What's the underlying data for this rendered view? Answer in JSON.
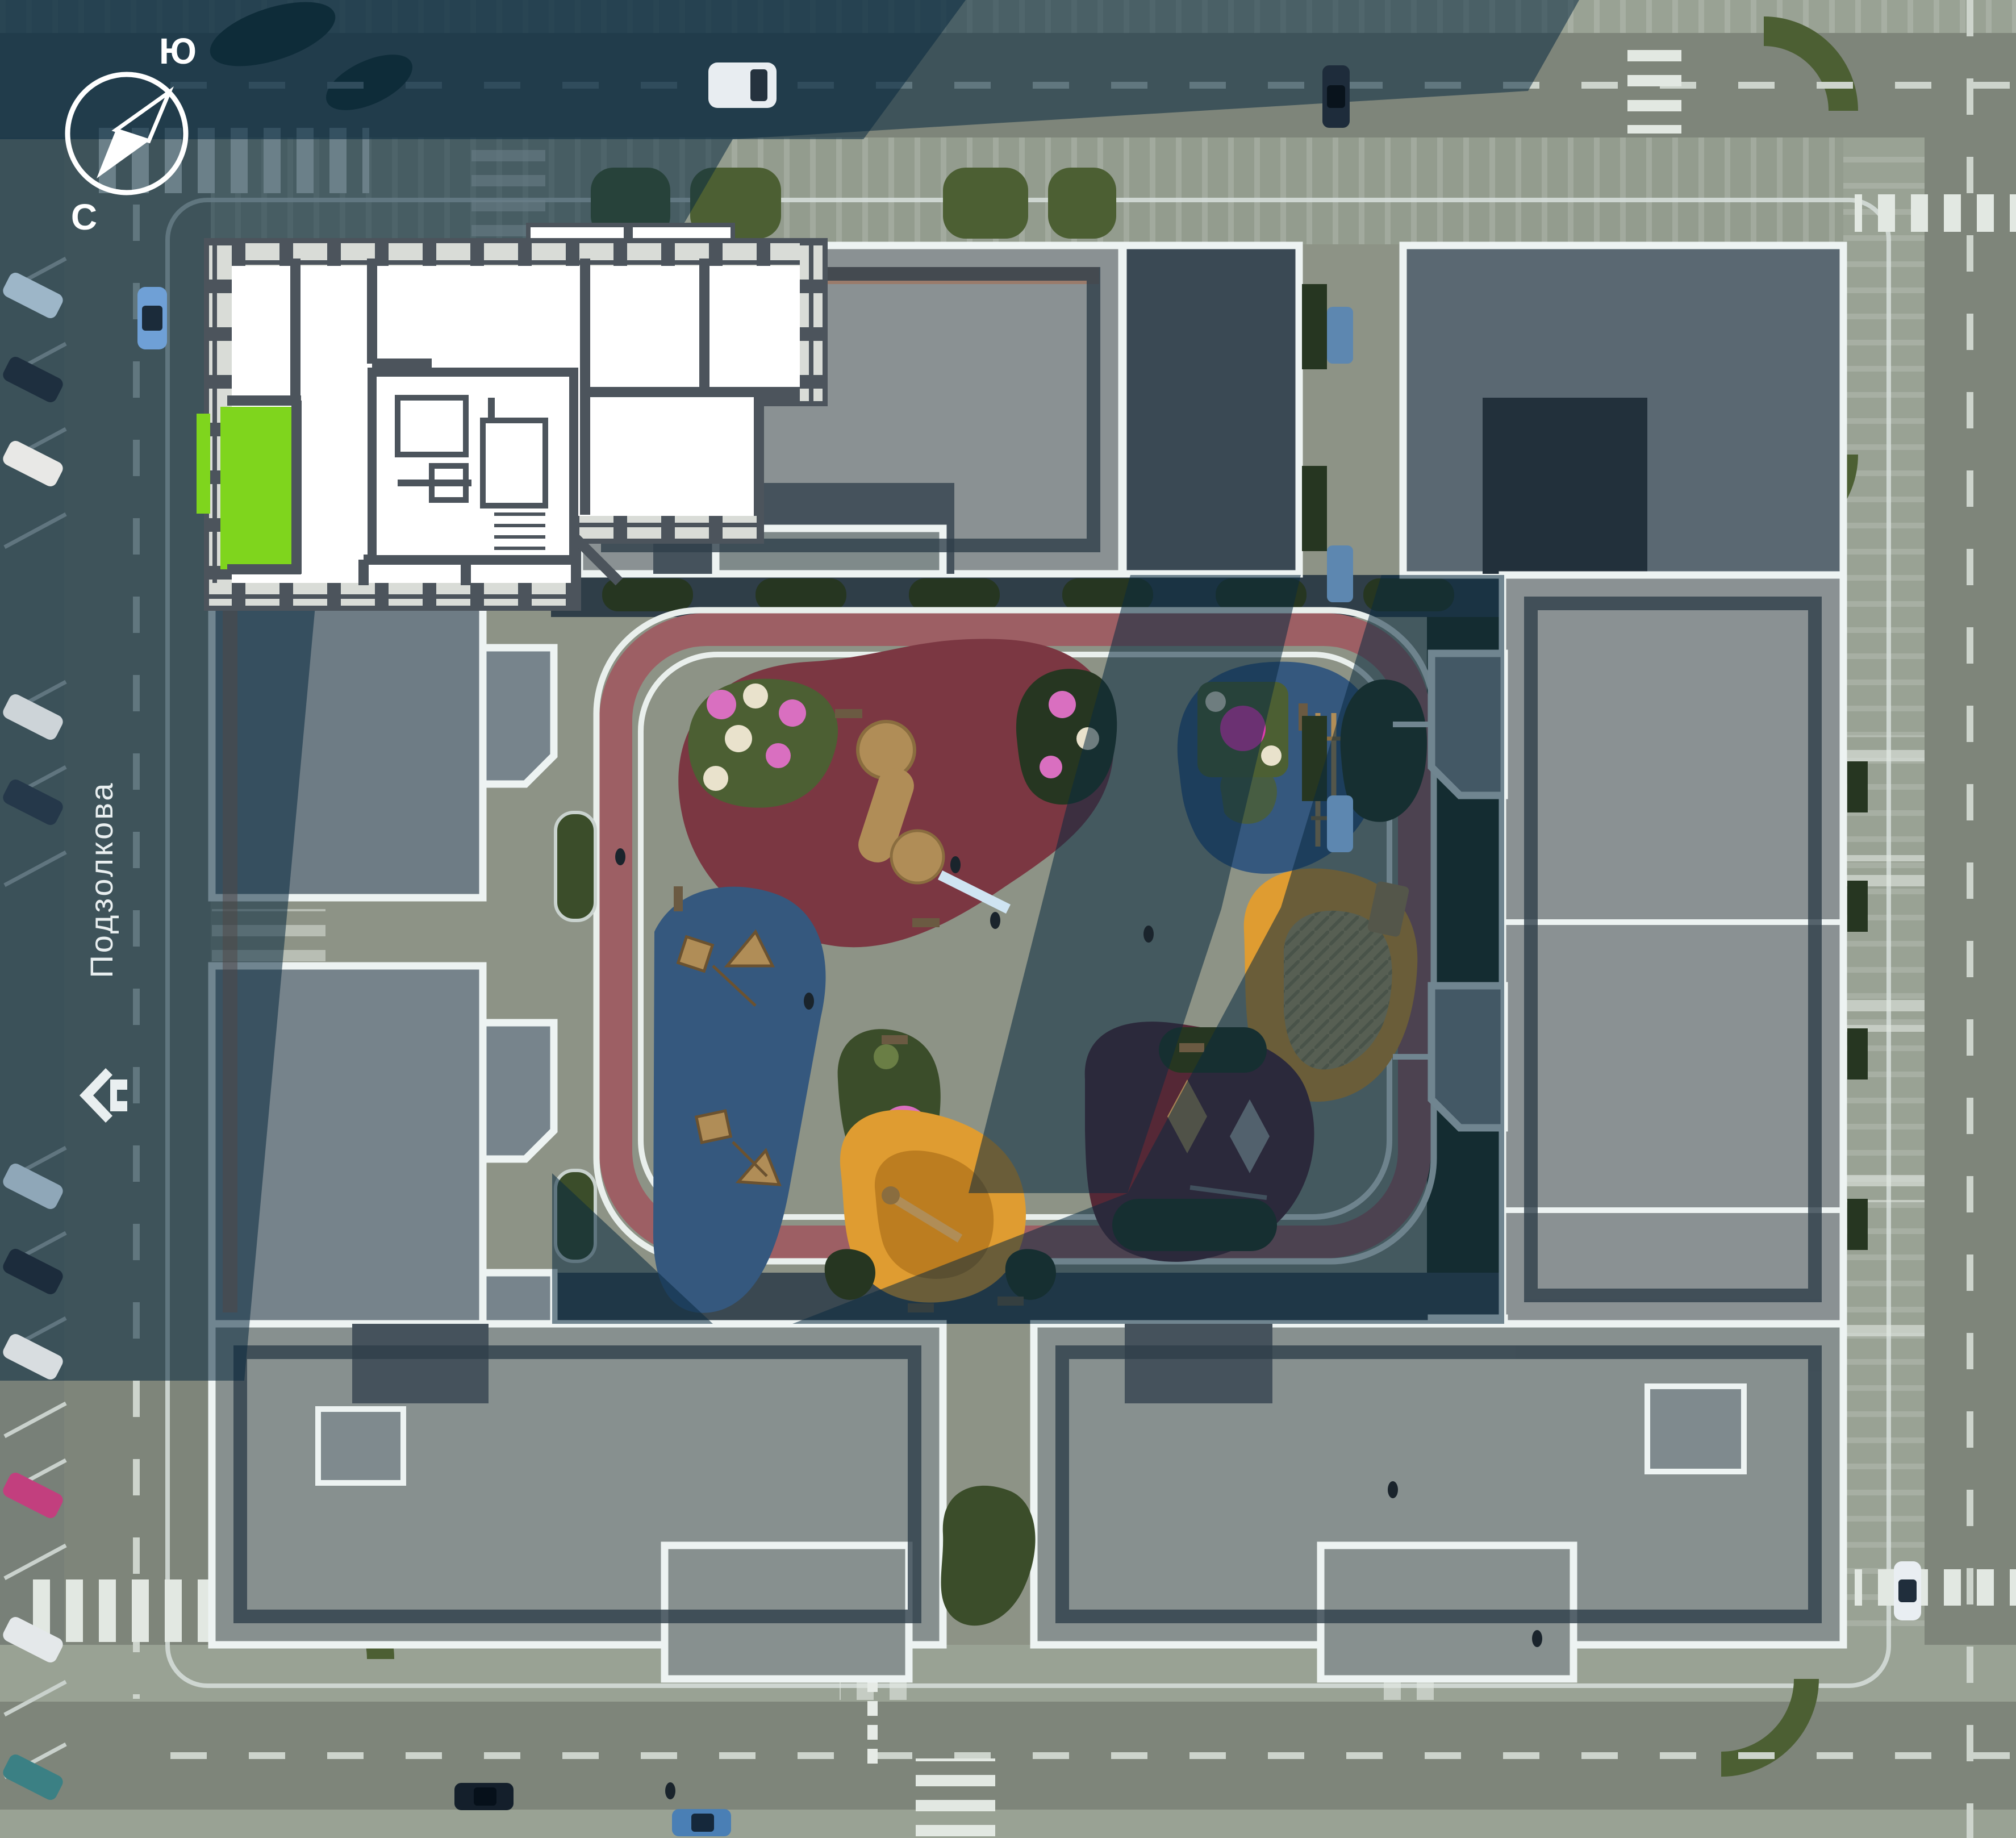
{
  "scene": {
    "type": "residential-complex-aerial-site-plan",
    "compass": {
      "label_top": "Ю",
      "label_bottom": "С"
    },
    "street": {
      "name": "Подзолкова"
    },
    "selected_apartment": {
      "highlight_color": "#7FD51D"
    },
    "colors": {
      "ground": "#8D9386",
      "road": "#7E857A",
      "sidewalk": "#99A294",
      "roof_light": "#8A9193",
      "roof_medium": "#5A6872",
      "roof_dark": "#3D4B56",
      "roof_low": "#45525C",
      "parapet": "#EDF3F2",
      "accent_roofline": "#A86A4B",
      "shadow": "#0A2940",
      "track_red": "#9D5F64",
      "playground_red": "#7B3742",
      "playground_blue": "#35587E",
      "playground_orange": "#DF9C31",
      "playground_orange_dark": "#BC7D20",
      "playground_maroon": "#552836",
      "sand": "#B5A06A",
      "greenery": "#4C5F33",
      "greenery_dark": "#263621",
      "flowers_pink": "#D96FC0",
      "flowers_magenta": "#E23BB0",
      "flowers_white": "#E9E2CC",
      "wood": "#B08D57",
      "marking_white": "#DFE5E0",
      "plan_wall": "#4C545C",
      "plan_room": "#FFFFFF",
      "plan_window": "#D9DCD7"
    }
  }
}
